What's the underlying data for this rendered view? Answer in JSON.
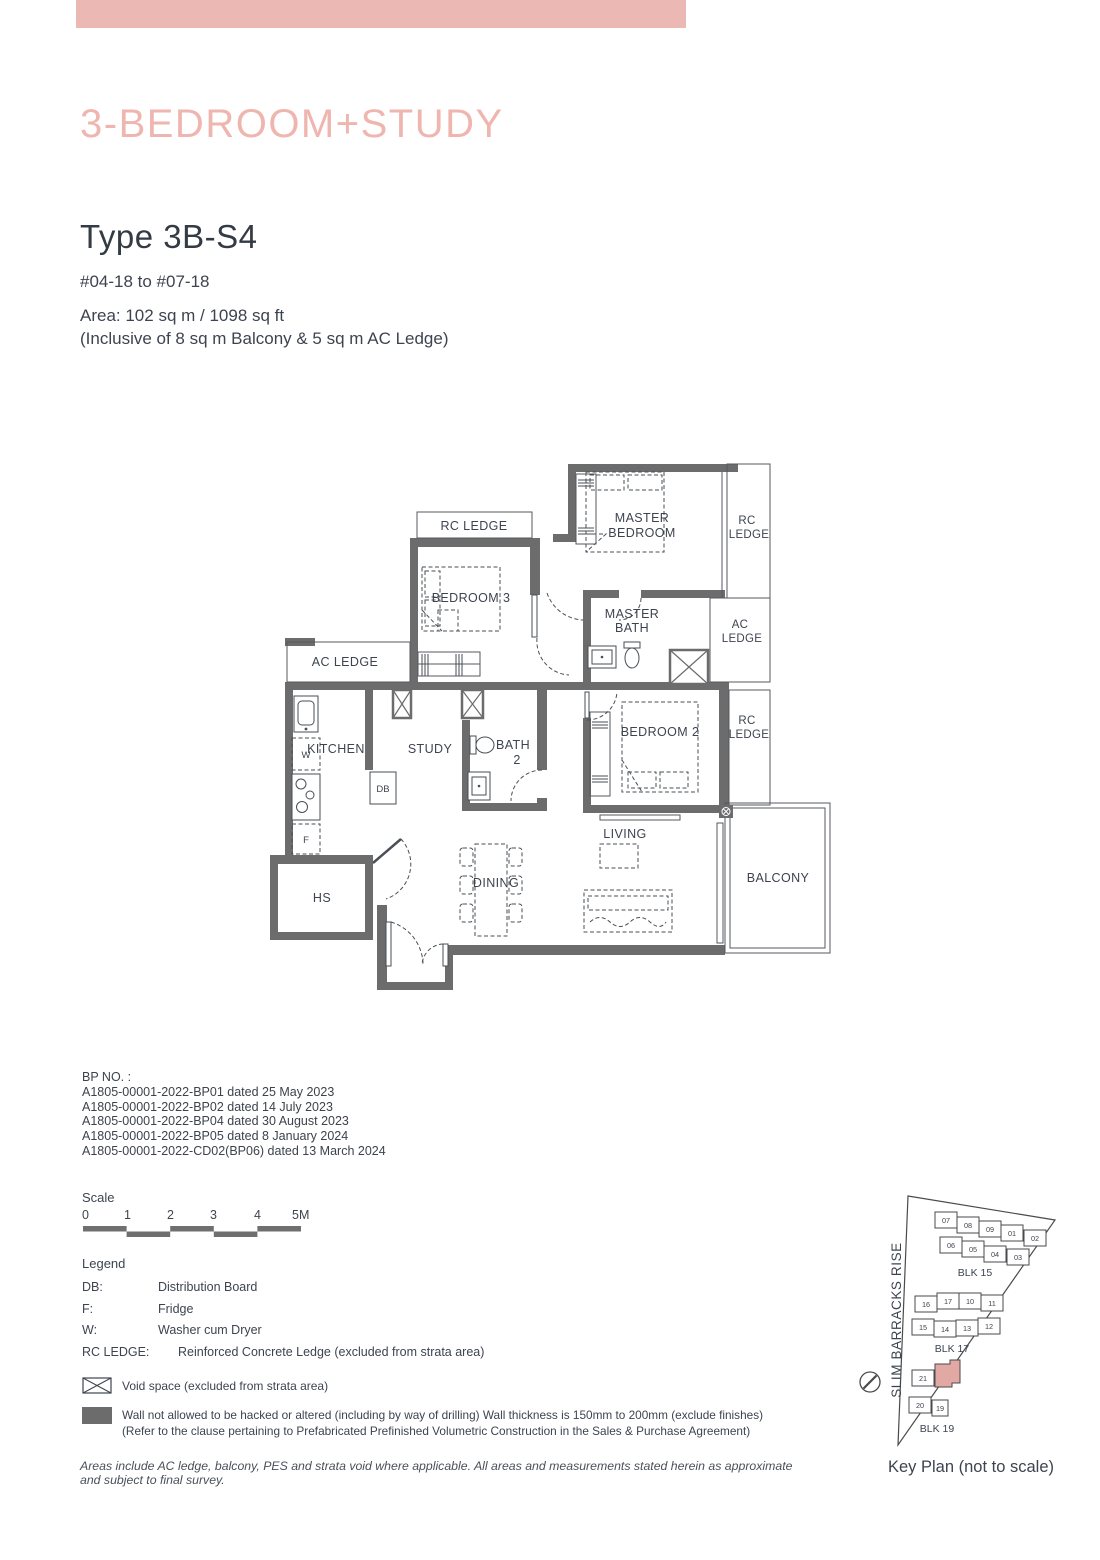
{
  "page": {
    "banner_color": "#ecb8b4",
    "title": "3-BEDROOM+STUDY",
    "type_title": "Type 3B-S4",
    "floor_range": "#04-18 to #07-18",
    "area_line1": "Area: 102 sq m / 1098 sq ft",
    "area_line2": "(Inclusive of 8 sq m Balcony & 5 sq m AC Ledge)"
  },
  "floorplan": {
    "wall_color": "#6c6c6c",
    "rooms": {
      "rc_ledge_top": "RC LEDGE",
      "master_1": "MASTER",
      "master_2": "BEDROOM",
      "rc_r1_1": "RC",
      "rc_r1_2": "LEDGE",
      "bedroom3": "BEDROOM 3",
      "ac_left": "AC LEDGE",
      "mbath_1": "MASTER",
      "mbath_2": "BATH",
      "ac_r_1": "AC",
      "ac_r_2": "LEDGE",
      "kitchen": "KITCHEN",
      "study": "STUDY",
      "bath2_1": "BATH",
      "bath2_2": "2",
      "bedroom2": "BEDROOM 2",
      "rc_r2_1": "RC",
      "rc_r2_2": "LEDGE",
      "db": "DB",
      "w": "W",
      "f": "F",
      "hs": "HS",
      "dining": "DINING",
      "living": "LIVING",
      "balcony": "BALCONY"
    }
  },
  "bp": {
    "heading": "BP NO. :",
    "lines": [
      "A1805-00001-2022-BP01 dated 25 May 2023",
      "A1805-00001-2022-BP02 dated 14 July 2023",
      "A1805-00001-2022-BP04 dated 30 August 2023",
      "A1805-00001-2022-BP05 dated 8 January 2024",
      "A1805-00001-2022-CD02(BP06) dated 13 March 2024"
    ]
  },
  "scale": {
    "label": "Scale",
    "ticks": [
      "0",
      "1",
      "2",
      "3",
      "4",
      "5M"
    ]
  },
  "legend": {
    "heading": "Legend",
    "rows": [
      {
        "term": "DB:",
        "desc": "Distribution Board"
      },
      {
        "term": "F:",
        "desc": "Fridge"
      },
      {
        "term": "W:",
        "desc": "Washer cum Dryer"
      },
      {
        "term": "RC LEDGE:",
        "desc": "Reinforced Concrete Ledge (excluded from strata area)"
      }
    ],
    "void_note": "Void space (excluded from strata area)",
    "wall_note_1": "Wall not allowed to be hacked or altered (including by way of drilling) Wall thickness is 150mm to 200mm (exclude finishes)",
    "wall_note_2": "(Refer to the clause pertaining to Prefabricated Prefinished Volumetric Construction in the Sales & Purchase Agreement)"
  },
  "footer": "Areas include AC ledge, balcony, PES and strata void where applicable. All areas and measurements stated herein as approximate and subject to final survey.",
  "keyplan": {
    "street": "SLIM BARRACKS RISE",
    "caption": "Key Plan (not to scale)",
    "highlight_color": "#e2a9a4",
    "blk15": {
      "label": "BLK 15",
      "row1": [
        "07",
        "08",
        "09",
        "01",
        "02"
      ],
      "row2": [
        "06",
        "05",
        "04",
        "03"
      ]
    },
    "blk17": {
      "label": "BLK 17",
      "row1": [
        "16",
        "17",
        "10",
        "11"
      ],
      "row2": [
        "15",
        "14",
        "13",
        "12"
      ]
    },
    "blk19": {
      "label": "BLK 19",
      "units": [
        "21",
        "20",
        "19"
      ]
    }
  }
}
